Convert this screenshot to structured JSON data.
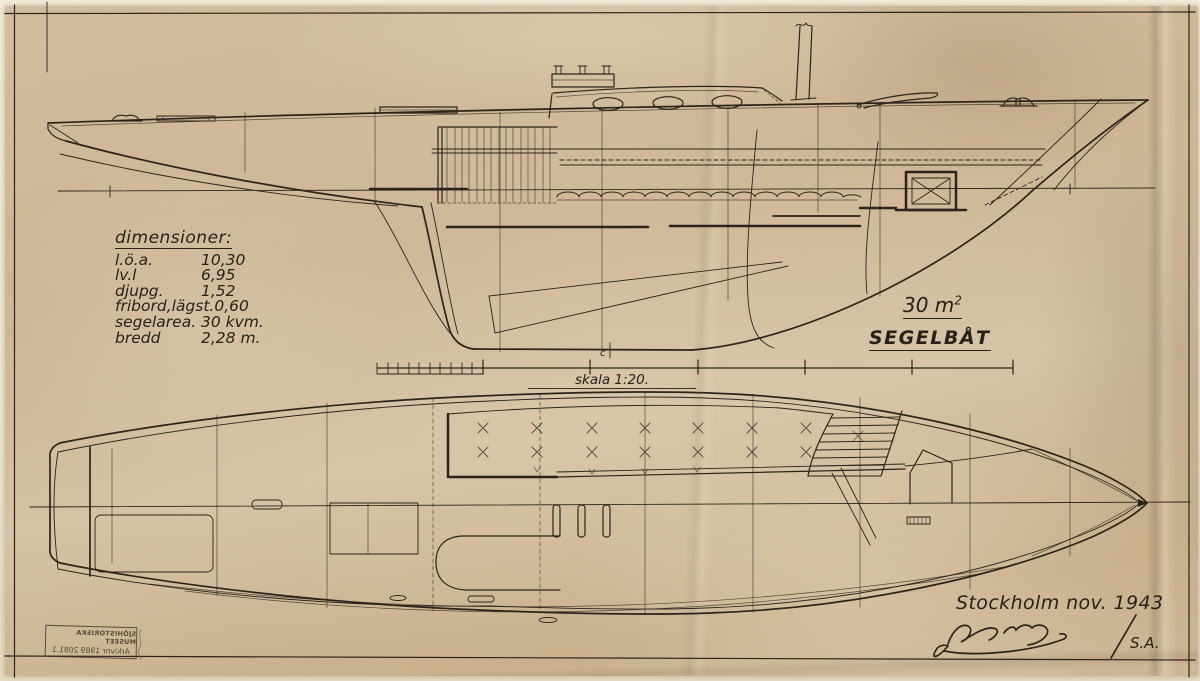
{
  "drawing": {
    "boat_type": "SEGELBÅT",
    "sail_area": "30 m",
    "sail_area_sup": "2",
    "scale_label": "skala 1:20.",
    "centerline_mark": "c",
    "place_date": "Stockholm nov. 1943",
    "series_mark": "S.A."
  },
  "dimensions_table": {
    "title": "dimensioner:",
    "rows": [
      {
        "label": "l.ö.a.",
        "value": "10,30"
      },
      {
        "label": "lv.l",
        "value": "6,95"
      },
      {
        "label": "djupg.",
        "value": "1,52"
      },
      {
        "label": "fribord,lägst.",
        "value": "0,60"
      },
      {
        "label": "segelarea.",
        "value": "30 kvm."
      },
      {
        "label": "bredd",
        "value": "2,28 m."
      }
    ]
  },
  "stamp": {
    "line1": "SJÖHISTORISKA MUSEET",
    "line2": "Arkivnr 1989 2081.1"
  },
  "colors": {
    "paper": "#cdb493",
    "ink": "#2b241c",
    "backing": "#efe8d4"
  }
}
